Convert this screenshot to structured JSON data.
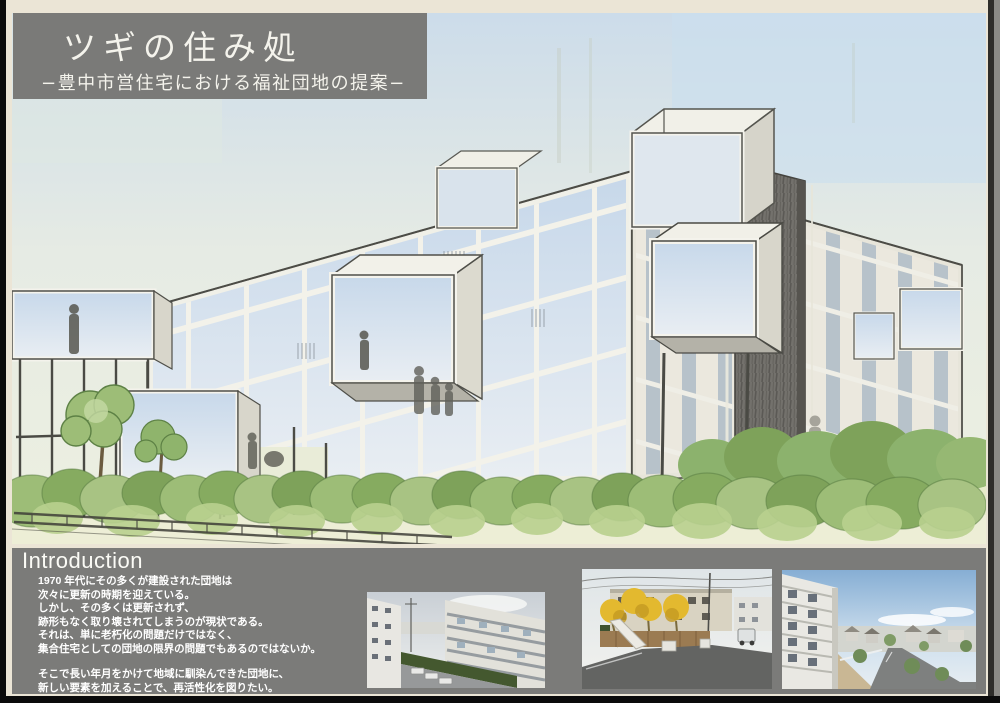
{
  "page": {
    "background_color": "#ebe5d6",
    "frame_color": "#0b0b0b",
    "panel_color": "#7b7b79",
    "sky_color": "#cfdeec",
    "hedge_color": "#8fb671"
  },
  "header": {
    "title": "ツギの住み処",
    "subtitle": "−豊中市営住宅における福祉団地の提案−"
  },
  "illustration": {
    "name": "watercolor-pencil-perspective-sketch-of-modular-welfare-housing",
    "elements": [
      "modular glass box apartments",
      "dark hatched stair tower",
      "stilt columns",
      "hedgerow",
      "trees",
      "resident silhouettes"
    ]
  },
  "introduction": {
    "heading": "Introduction",
    "paragraph1": [
      "1970 年代にその多くが建設された団地は",
      "次々に更新の時期を迎えている。",
      "しかし、その多くは更新されず、",
      "跡形もなく取り壊されてしまうのが現状である。",
      "それは、単に老朽化の問題だけではなく、",
      "集合住宅としての団地の限界の問題でもあるのではないか。"
    ],
    "paragraph2": [
      "そこで長い年月をかけて地域に馴染んできた団地に、",
      "新しい要素を加えることで、再活性化を図りたい。"
    ],
    "photos": [
      {
        "name": "existing-danchi-courtyard-and-parking"
      },
      {
        "name": "danchi-street-with-ginkgo-trees-and-slide"
      },
      {
        "name": "danchi-building-and-neighborhood-view"
      }
    ]
  }
}
